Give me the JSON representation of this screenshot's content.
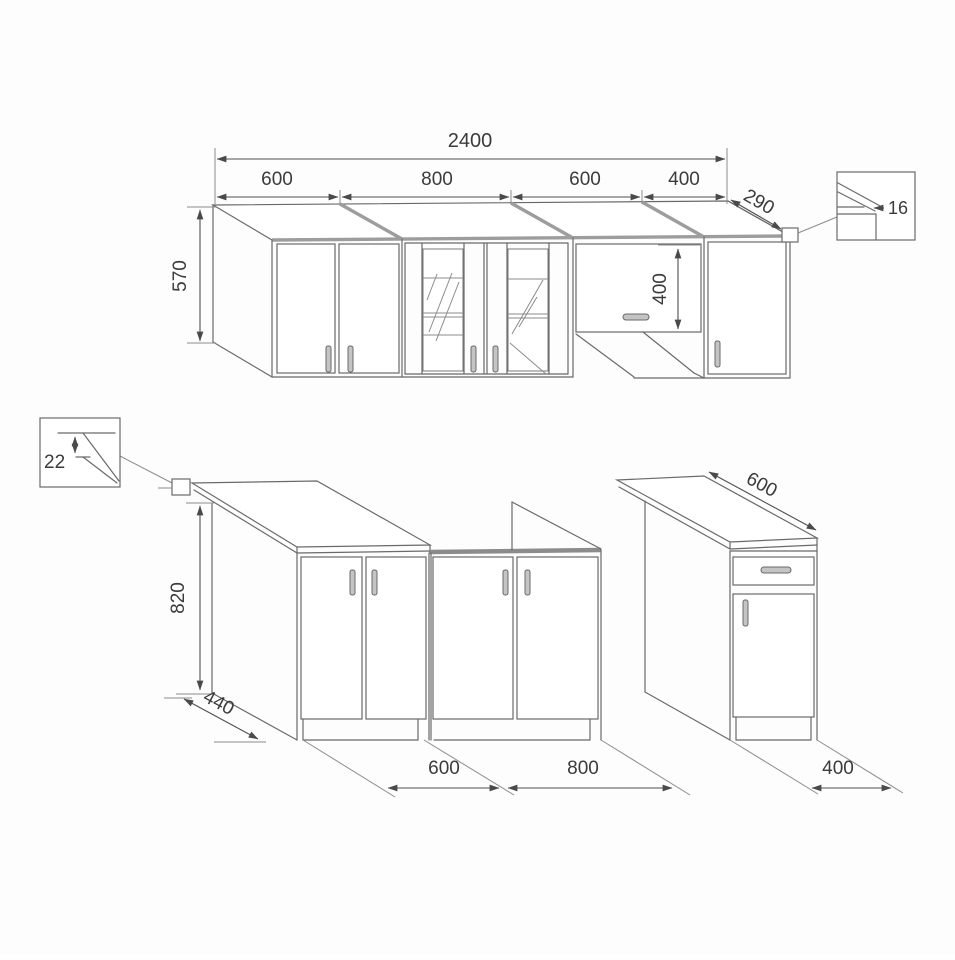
{
  "wall_units": {
    "total_width": "2400",
    "unit_widths": [
      "600",
      "800",
      "600",
      "400"
    ],
    "height": "570",
    "depth": "290",
    "flap_door_height": "400",
    "panel_thickness_detail": "16"
  },
  "base_units": {
    "height": "820",
    "cabinet_depth": "440",
    "worktop_depth": "600",
    "worktop_thickness_detail": "22",
    "unit_widths": [
      "600",
      "800",
      "400"
    ]
  }
}
